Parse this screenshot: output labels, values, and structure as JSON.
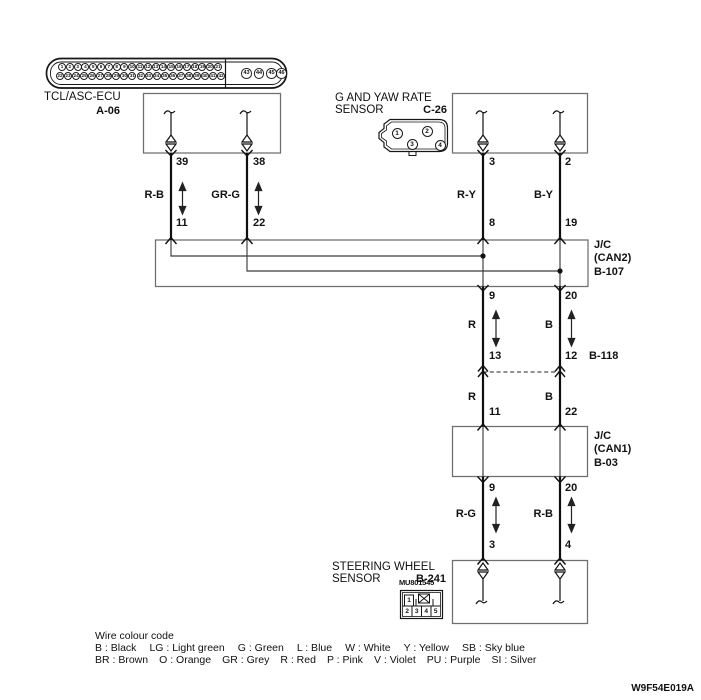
{
  "doc_id": "W9F54E019A",
  "components": {
    "ecu": {
      "name": "TCL/ASC-ECU",
      "code": "A-06"
    },
    "g_yaw": {
      "name1": "G AND YAW RATE",
      "name2": "SENSOR",
      "code": "C-26",
      "pins": [
        "1",
        "2",
        "3",
        "4"
      ]
    },
    "jc_can2": {
      "l1": "J/C",
      "l2": "(CAN2)",
      "l3": "B-107"
    },
    "b118": {
      "code": "B-118"
    },
    "jc_can1": {
      "l1": "J/C",
      "l2": "(CAN1)",
      "l3": "B-03"
    },
    "sws": {
      "name1": "STEERING WHEEL",
      "name2": "SENSOR",
      "code": "B-241",
      "part_no": "MU801545",
      "pinout": {
        "top": [
          "1"
        ],
        "bottom": [
          "2",
          "3",
          "4",
          "5"
        ]
      }
    }
  },
  "ecu_connector": {
    "row1_from": 1,
    "row1_to": 21,
    "row2_from": 22,
    "row2_to": 42,
    "aux": [
      43,
      44,
      45,
      46
    ]
  },
  "wires": {
    "ecu_l": {
      "top": "39",
      "label": "R-B",
      "bottom": "11"
    },
    "ecu_r": {
      "top": "38",
      "label": "GR-G",
      "bottom": "22"
    },
    "sen_l": {
      "top": "3",
      "label": "R-Y",
      "bottom": "8"
    },
    "sen_r": {
      "top": "2",
      "label": "B-Y",
      "bottom": "19"
    },
    "can2_l": {
      "top": "9",
      "label": "R",
      "bottom": "13"
    },
    "can2_r": {
      "top": "20",
      "label": "B",
      "bottom": "12"
    },
    "b118_l": {
      "label": "R",
      "bottom": "11"
    },
    "b118_r": {
      "label": "B",
      "bottom": "22"
    },
    "can1_l": {
      "top": "9",
      "label": "R-G",
      "bottom": "3"
    },
    "can1_r": {
      "top": "20",
      "label": "R-B",
      "bottom": "4"
    }
  },
  "legend": {
    "title": "Wire colour code",
    "row1": [
      {
        "code": "B",
        "name": "Black"
      },
      {
        "code": "LG",
        "name": "Light green"
      },
      {
        "code": "G",
        "name": "Green"
      },
      {
        "code": "L",
        "name": "Blue"
      },
      {
        "code": "W",
        "name": "White"
      },
      {
        "code": "Y",
        "name": "Yellow"
      },
      {
        "code": "SB",
        "name": "Sky blue"
      }
    ],
    "row2": [
      {
        "code": "BR",
        "name": "Brown"
      },
      {
        "code": "O",
        "name": "Orange"
      },
      {
        "code": "GR",
        "name": "Grey"
      },
      {
        "code": "R",
        "name": "Red"
      },
      {
        "code": "P",
        "name": "Pink"
      },
      {
        "code": "V",
        "name": "Violet"
      },
      {
        "code": "PU",
        "name": "Purple"
      },
      {
        "code": "SI",
        "name": "Silver"
      }
    ]
  }
}
